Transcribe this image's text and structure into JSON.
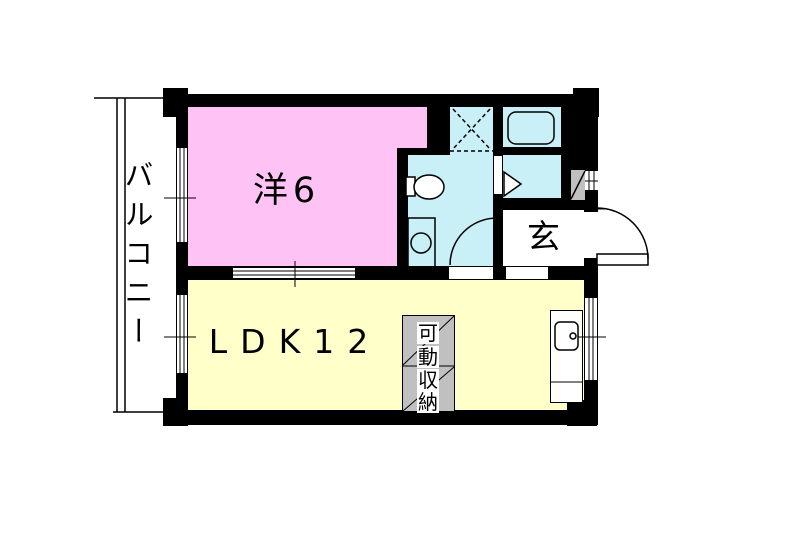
{
  "floorplan": {
    "labels": {
      "balcony": "バルコニー",
      "western_room": "洋6",
      "ldk": "LDK12",
      "entrance": "玄",
      "storage": "可動収納",
      "storage_chars": [
        "可",
        "動",
        "収",
        "納"
      ]
    },
    "colors": {
      "wall": "#000000",
      "western_room_floor": "#FFC2F5",
      "wet_area_floor": "#C9EFF7",
      "ldk_floor": "#FFFFC9",
      "storage_fill": "#C0C0C0",
      "background": "#FFFFFF"
    },
    "fixtures": [
      "bathtub",
      "washing-machine-space",
      "toilet",
      "washbasin-counter",
      "kitchen-sink",
      "movable-storage",
      "pipe-space",
      "entrance-door-swing",
      "washroom-door-swing",
      "bathroom-folding-door",
      "sash-windows",
      "dimension-ticks"
    ]
  }
}
